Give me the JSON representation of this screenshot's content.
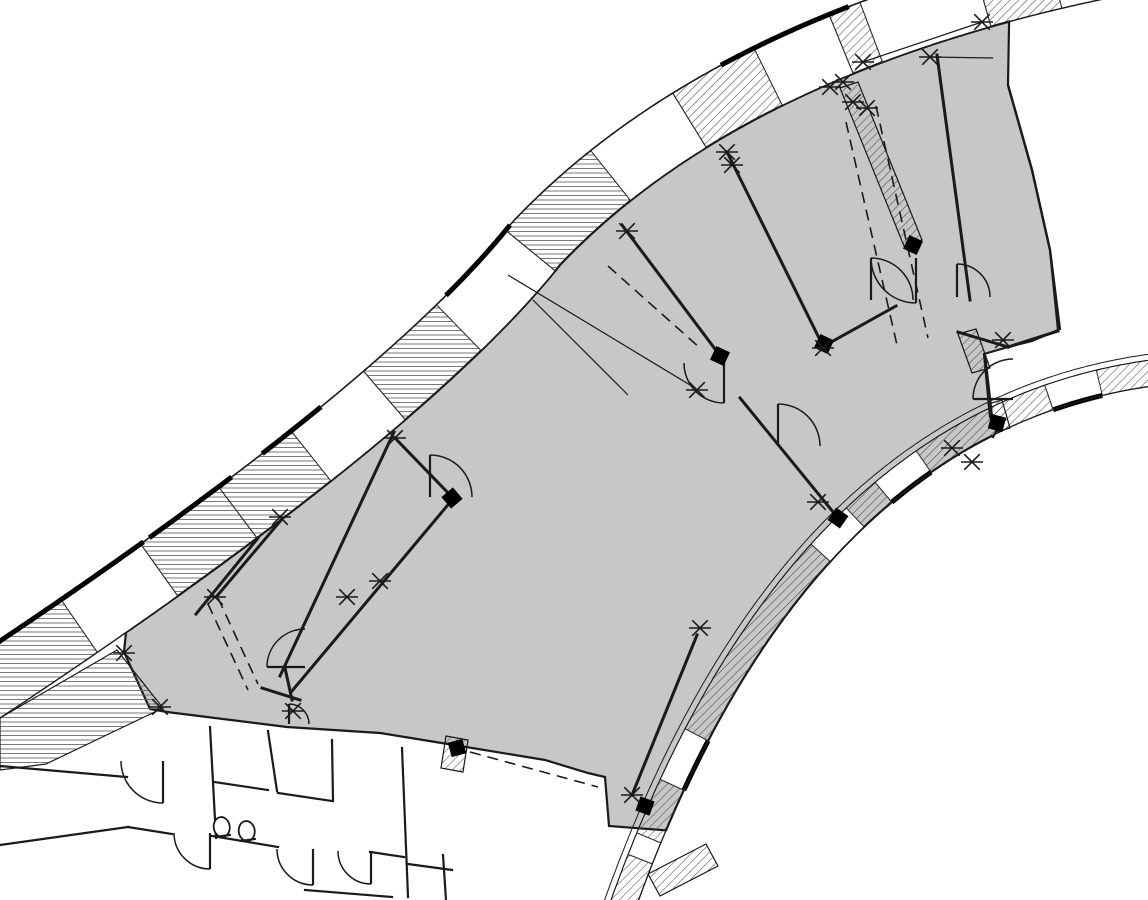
{
  "canvas": {
    "width": 1148,
    "height": 900,
    "bg": "#ffffff"
  },
  "palette": {
    "floor": "#c7c7c7",
    "line": "#1a1a1a",
    "cell_stroke": "#2a2a2a",
    "hatch_dark": "#4a4a4a",
    "hatch_fine": "#6b6b6b",
    "thick": "#000000",
    "white": "#ffffff"
  },
  "top_band": {
    "segments": [
      {
        "p": [
          0,
          718
        ],
        "c": [
          420,
          440
        ],
        "q": [
          560,
          265
        ]
      },
      {
        "p": [
          560,
          265
        ],
        "c": [
          754,
          61
        ],
        "q": [
          1160,
          -12
        ]
      }
    ],
    "width": 64,
    "cell_bounds_x": [
      0,
      95,
      175,
      255,
      330,
      405,
      480,
      555,
      630,
      705,
      780,
      852,
      880,
      990,
      1060,
      1150,
      1245
    ],
    "cell_fills": [
      "h2",
      "w",
      "h2",
      "h2",
      "w",
      "h2",
      "w",
      "h2",
      "w",
      "h",
      "w",
      "h",
      "w",
      "h",
      "w",
      "h"
    ],
    "thick_ranges_x": [
      [
        0,
        180
      ],
      [
        185,
        270
      ],
      [
        300,
        360
      ],
      [
        490,
        560
      ],
      [
        750,
        870
      ]
    ]
  },
  "right_band": {
    "segment": {
      "p": [
        1160,
        385
      ],
      "c": [
        800,
        430
      ],
      "q": [
        628,
        930
      ]
    },
    "width": 26,
    "outer2_offset": 32,
    "cells": [
      {
        "t0": 0.0,
        "t1": 0.08,
        "f": "h"
      },
      {
        "t0": 0.08,
        "t1": 0.155,
        "f": "b"
      },
      {
        "t0": 0.155,
        "t1": 0.35,
        "f": "h"
      },
      {
        "t0": 0.35,
        "t1": 0.42,
        "f": "b"
      },
      {
        "t0": 0.42,
        "t1": 0.47,
        "f": "h"
      },
      {
        "t0": 0.47,
        "t1": 0.53,
        "f": "w"
      },
      {
        "t0": 0.53,
        "t1": 0.79,
        "f": "h"
      },
      {
        "t0": 0.79,
        "t1": 0.85,
        "f": "b"
      },
      {
        "t0": 0.85,
        "t1": 0.91,
        "f": "h"
      },
      {
        "t0": 0.91,
        "t1": 0.93,
        "f": "w"
      },
      {
        "t0": 0.93,
        "t1": 1.0,
        "f": "h"
      }
    ]
  },
  "floor": {
    "top_u_range": [
      0.156,
      1.807
    ],
    "right_pts": [
      [
        1008,
        85
      ],
      [
        1032,
        170
      ],
      [
        1050,
        250
      ],
      [
        1058,
        330
      ],
      [
        1032,
        341
      ],
      [
        1008,
        347
      ],
      [
        984,
        354
      ],
      [
        990,
        417
      ],
      [
        997,
        430
      ],
      [
        993,
        437
      ]
    ],
    "right_curve_t": [
      0.25,
      0.895
    ],
    "bottom_pts": [
      [
        609,
        826
      ],
      [
        605,
        777
      ],
      [
        588,
        773
      ],
      [
        545,
        760
      ],
      [
        460,
        746
      ],
      [
        380,
        733
      ],
      [
        287,
        727
      ],
      [
        167,
        712
      ],
      [
        150,
        709
      ],
      [
        124,
        652
      ]
    ]
  },
  "walls": [
    [
      395,
      438,
      452,
      497
    ],
    [
      394,
      432,
      280,
      676
    ],
    [
      452,
      500,
      292,
      691
    ],
    [
      282,
      519,
      217,
      596
    ],
    [
      258,
      538,
      196,
      614
    ],
    [
      622,
      225,
      718,
      353
    ],
    [
      727,
      152,
      820,
      340
    ],
    [
      740,
      398,
      838,
      518
    ],
    [
      896,
      306,
      826,
      345
    ],
    [
      697,
      635,
      632,
      795
    ],
    [
      937,
      55,
      970,
      300
    ],
    [
      985,
      357,
      992,
      420
    ],
    [
      958,
      332,
      1008,
      347
    ],
    [
      1008,
      347,
      1058,
      331
    ],
    [
      285,
      668,
      292,
      700
    ],
    [
      262,
      688,
      300,
      700
    ]
  ],
  "thin_lines": [
    [
      508,
      275,
      695,
      388
    ],
    [
      533,
      300,
      628,
      395
    ],
    [
      863,
      62,
      982,
      22
    ],
    [
      930,
      57,
      993,
      58
    ]
  ],
  "dashed_lines": [
    [
      846,
      122,
      897,
      345
    ],
    [
      876,
      106,
      928,
      338
    ],
    [
      218,
      598,
      258,
      684
    ],
    [
      208,
      604,
      248,
      690
    ],
    [
      470,
      752,
      598,
      787
    ],
    [
      608,
      266,
      700,
      348
    ]
  ],
  "curve_wall_pts": [
    [
      1008,
      85
    ],
    [
      1032,
      170
    ],
    [
      1050,
      250
    ],
    [
      1060,
      330
    ]
  ],
  "hatched_stubs": [
    {
      "pts": [
        [
          840,
          88
        ],
        [
          858,
          82
        ],
        [
          922,
          240
        ],
        [
          904,
          246
        ]
      ],
      "f": "h"
    },
    {
      "pts": [
        [
          958,
          334
        ],
        [
          976,
          329
        ],
        [
          990,
          368
        ],
        [
          972,
          373
        ]
      ],
      "f": "h"
    },
    {
      "pts": [
        [
          988,
          404
        ],
        [
          1002,
          400
        ],
        [
          1010,
          428
        ],
        [
          996,
          432
        ]
      ],
      "f": "h"
    },
    {
      "pts": [
        [
          446,
          736
        ],
        [
          468,
          740
        ],
        [
          463,
          772
        ],
        [
          441,
          768
        ]
      ],
      "f": "h"
    },
    {
      "pts": [
        [
          0,
          718
        ],
        [
          117,
          650
        ],
        [
          163,
          708
        ],
        [
          46,
          764
        ],
        [
          0,
          770
        ]
      ],
      "f": "h2"
    },
    {
      "pts": [
        [
          648,
          874
        ],
        [
          706,
          844
        ],
        [
          718,
          866
        ],
        [
          660,
          896
        ]
      ],
      "f": "h"
    }
  ],
  "doors": [
    {
      "c": [
        305,
        667
      ],
      "r": 38,
      "a0": 180,
      "a1": 270
    },
    {
      "c": [
        289,
        724
      ],
      "r": 20,
      "a0": 270,
      "a1": 360
    },
    {
      "c": [
        430,
        497
      ],
      "r": 42,
      "a0": 270,
      "a1": 360
    },
    {
      "c": [
        724,
        363
      ],
      "r": 40,
      "a0": 90,
      "a1": 180
    },
    {
      "c": [
        778,
        446
      ],
      "r": 42,
      "a0": 270,
      "a1": 360
    },
    {
      "c": [
        916,
        258
      ],
      "r": 45,
      "a0": 90,
      "a1": 180
    },
    {
      "c": [
        871,
        300
      ],
      "r": 42,
      "a0": 270,
      "a1": 360
    },
    {
      "c": [
        1013,
        399
      ],
      "r": 40,
      "a0": 180,
      "a1": 270
    },
    {
      "c": [
        957,
        297
      ],
      "r": 33,
      "a0": 270,
      "a1": 360
    },
    {
      "c": [
        163,
        761
      ],
      "r": 42,
      "a0": 90,
      "a1": 180
    },
    {
      "c": [
        210,
        833
      ],
      "r": 36,
      "a0": 90,
      "a1": 180
    },
    {
      "c": [
        313,
        849
      ],
      "r": 36,
      "a0": 90,
      "a1": 180
    },
    {
      "c": [
        371,
        851
      ],
      "r": 33,
      "a0": 90,
      "a1": 180
    }
  ],
  "columns": [
    [
      452,
      498,
      -40
    ],
    [
      720,
      356,
      25
    ],
    [
      824,
      344,
      25
    ],
    [
      913,
      245,
      25
    ],
    [
      997,
      423,
      15
    ],
    [
      645,
      806,
      20
    ],
    [
      457,
      748,
      75
    ],
    [
      838,
      518,
      35
    ]
  ],
  "column_size": 15,
  "markers": [
    [
      124,
      653
    ],
    [
      160,
      707
    ],
    [
      293,
      711
    ],
    [
      215,
      597
    ],
    [
      280,
      517
    ],
    [
      347,
      597
    ],
    [
      380,
      581
    ],
    [
      395,
      438
    ],
    [
      627,
      231
    ],
    [
      697,
      390
    ],
    [
      727,
      152
    ],
    [
      732,
      165
    ],
    [
      830,
      87
    ],
    [
      843,
      82
    ],
    [
      853,
      102
    ],
    [
      867,
      108
    ],
    [
      863,
      62
    ],
    [
      982,
      22
    ],
    [
      930,
      57
    ],
    [
      818,
      502
    ],
    [
      823,
      348
    ],
    [
      700,
      628
    ],
    [
      632,
      795
    ],
    [
      952,
      448
    ],
    [
      972,
      462
    ],
    [
      1003,
      340
    ]
  ],
  "marker_size": 11,
  "room_walls": [
    [
      0,
      766,
      127,
      777
    ],
    [
      0,
      845,
      128,
      827
    ],
    [
      128,
      827,
      172,
      834
    ],
    [
      210,
      727,
      216,
      838
    ],
    [
      212,
      836,
      278,
      847
    ],
    [
      214,
      782,
      268,
      790
    ],
    [
      268,
      731,
      277,
      791
    ],
    [
      278,
      793,
      332,
      801
    ],
    [
      332,
      740,
      333,
      801
    ],
    [
      402,
      748,
      408,
      897
    ],
    [
      408,
      864,
      452,
      870
    ],
    [
      305,
      890,
      392,
      897
    ],
    [
      443,
      855,
      446,
      900
    ],
    [
      370,
      852,
      404,
      857
    ]
  ],
  "toilets": [
    [
      222,
      829,
      -8
    ],
    [
      247,
      833,
      -8
    ]
  ]
}
